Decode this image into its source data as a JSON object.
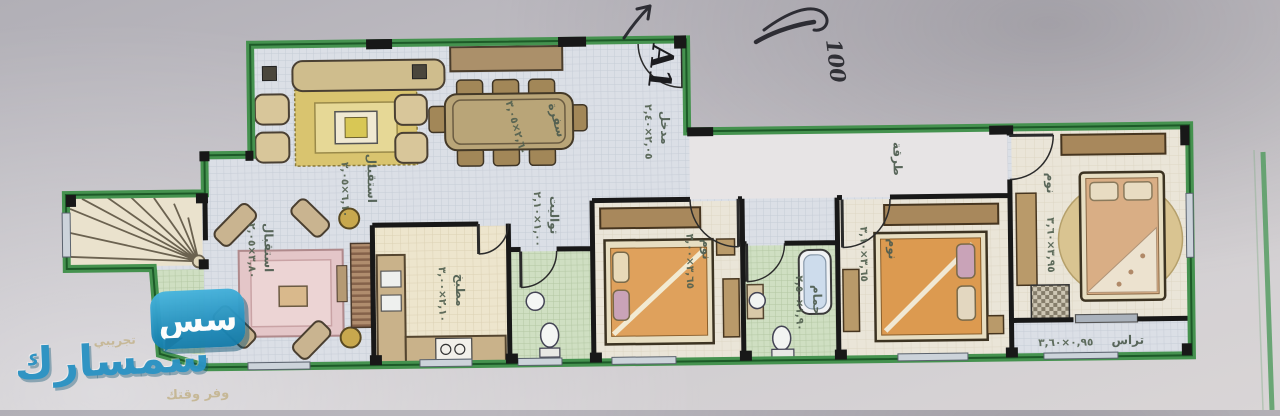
{
  "plan": {
    "unit_label": "A1",
    "handwriting": "100",
    "rooms": [
      {
        "name": "مدخل",
        "dims": "٢,٠٥×٢,٤٠"
      },
      {
        "name": "سفرة",
        "dims": "٢,٦٠×٣,٠٥"
      },
      {
        "name": "استقبال",
        "dims": "٦,١٠×٣,٠٥"
      },
      {
        "name": "استقبال",
        "dims": "٣,٨٠×٢,٠٥"
      },
      {
        "name": "مطبخ",
        "dims": "٢,١٠×٣,٠٠"
      },
      {
        "name": "تواليت",
        "dims": "١,٠٠×٢,١٠"
      },
      {
        "name": "نوم",
        "dims": "٣,٦٥×٣,٠٠"
      },
      {
        "name": "حمام",
        "dims": "١,٩٠×٢,٥٠"
      },
      {
        "name": "طرقة",
        "dims": ""
      },
      {
        "name": "نوم",
        "dims": "٣,٦٥×٣,١٠"
      },
      {
        "name": "نوم",
        "dims": "٣,٩٥×٣,٦٠"
      },
      {
        "name": "تراس",
        "dims": "٠,٩٥×٣,٦٠"
      }
    ],
    "colors": {
      "border_green": "#45924f",
      "wall_black": "#181818",
      "label_green": "#4d5c4f"
    }
  },
  "watermark": {
    "beta": "تجريبي",
    "brand": "سمسارك",
    "tagline": "وفر وقتك",
    "icon_glyph": "سس"
  }
}
